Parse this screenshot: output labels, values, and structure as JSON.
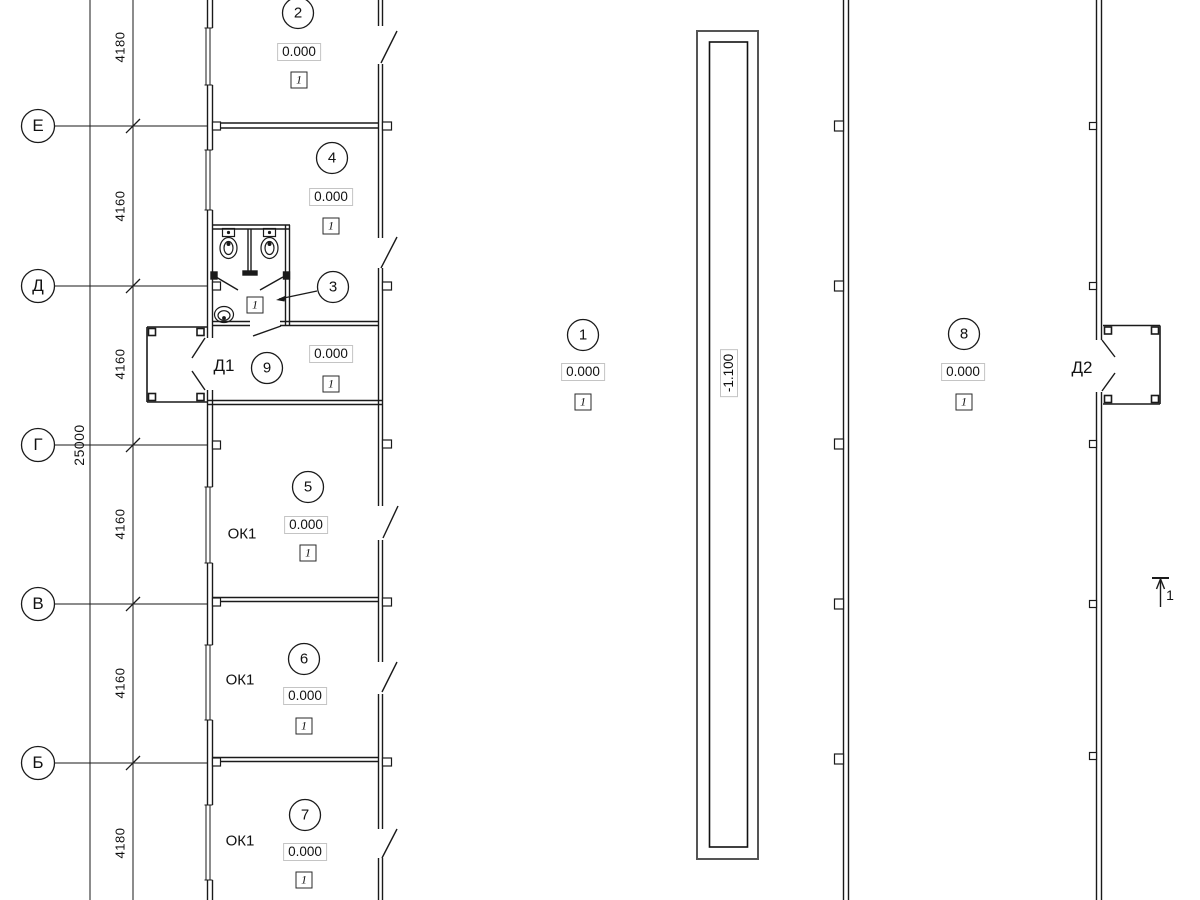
{
  "axes": {
    "items": [
      {
        "label": "Е"
      },
      {
        "label": "Д"
      },
      {
        "label": "Г"
      },
      {
        "label": "В"
      },
      {
        "label": "Б"
      }
    ]
  },
  "dims": {
    "seg0": "4180",
    "seg1": "4160",
    "seg2": "4160",
    "seg3": "4160",
    "seg4": "4160",
    "seg5": "4180",
    "total": "25000"
  },
  "rooms": [
    {
      "number": "2",
      "elevation": "0.000",
      "type": "1"
    },
    {
      "number": "4",
      "elevation": "0.000",
      "type": "1"
    },
    {
      "number": "3",
      "type": "1"
    },
    {
      "number": "9",
      "elevation": "0.000",
      "type": "1"
    },
    {
      "number": "5",
      "elevation": "0.000",
      "type": "1"
    },
    {
      "number": "6",
      "elevation": "0.000",
      "type": "1"
    },
    {
      "number": "7",
      "elevation": "0.000",
      "type": "1"
    },
    {
      "number": "1",
      "elevation": "0.000",
      "type": "1"
    },
    {
      "number": "8",
      "elevation": "0.000",
      "type": "1"
    }
  ],
  "doors": {
    "d1": "Д1",
    "d2": "Д2"
  },
  "windows": {
    "ok1": "ОК1"
  },
  "ramp": {
    "elevation": "-1.100"
  },
  "section": {
    "label": "1"
  },
  "colors": {
    "line": "#1a1a1a",
    "box_border": "#c4c4c4"
  }
}
